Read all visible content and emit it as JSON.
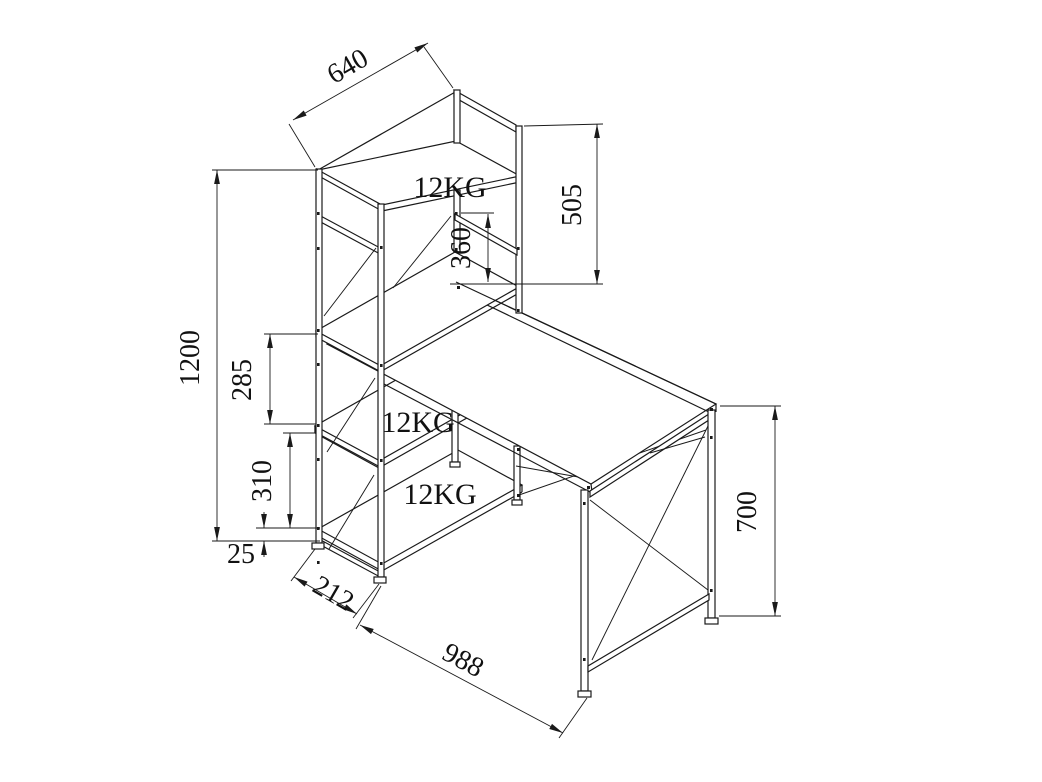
{
  "drawing": {
    "type": "isometric-furniture-dimension-drawing",
    "subject": "computer desk with four-tier shelf tower",
    "colors": {
      "line": "#1a1a1a",
      "background": "#ffffff"
    },
    "dimensions": {
      "top_shelf_depth": "640",
      "riser_height": "505",
      "shelf_to_desktop": "360",
      "tower_height": "1200",
      "upper_shelf_gap": "285",
      "lower_shelf_gap": "310",
      "base_clearance": "25",
      "tower_width": "212",
      "desk_length": "988",
      "desk_height": "700"
    },
    "load_labels": {
      "top_shelf": "12KG",
      "middle_shelf": "12KG",
      "bottom_shelf": "12KG"
    }
  }
}
